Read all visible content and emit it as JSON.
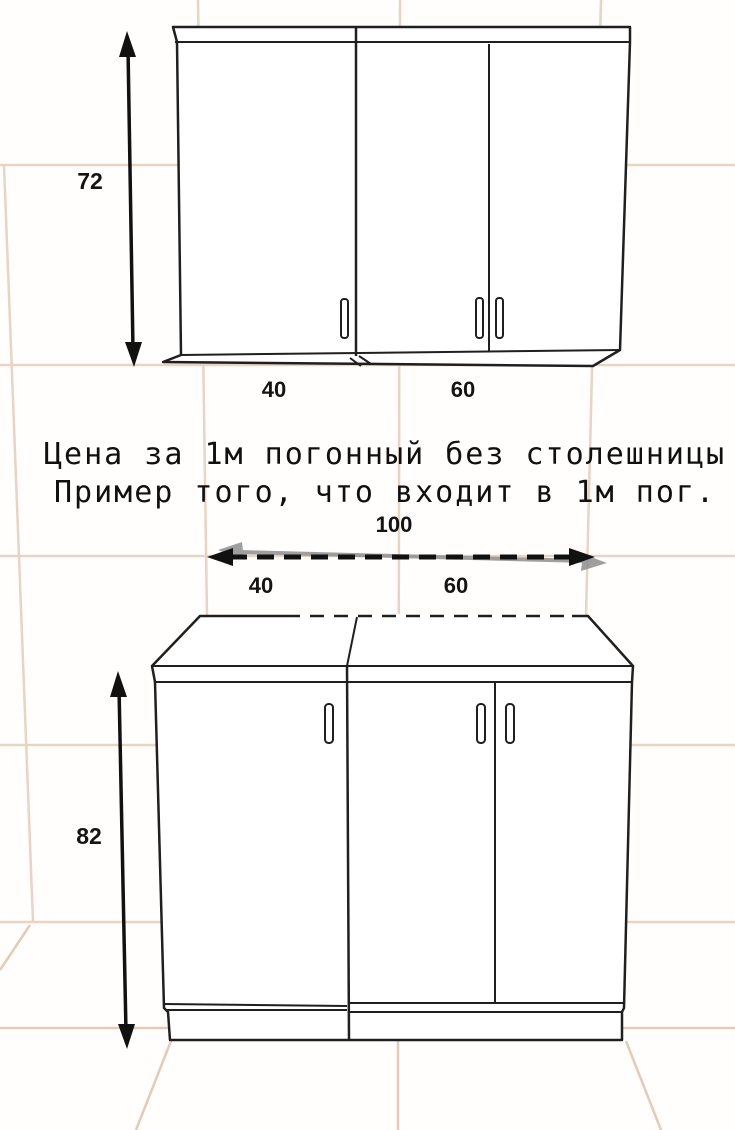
{
  "diagram": {
    "caption": {
      "line1": "Цена за 1м погонный без столешницы",
      "line2": "Пример того, что входит в 1м пог."
    },
    "wall_cabinet": {
      "height_cm": "72",
      "sections": [
        {
          "width_cm": "40",
          "doors": 1
        },
        {
          "width_cm": "60",
          "doors": 2
        }
      ]
    },
    "base_cabinet": {
      "height_cm": "82",
      "total_width_cm": "100",
      "sections": [
        {
          "width_cm": "40",
          "doors": 1
        },
        {
          "width_cm": "60",
          "doors": 2
        }
      ]
    },
    "colors": {
      "tile_line": "#e9d3c4",
      "floor_line": "#e5cab9",
      "drawing_line": "#1f1f1f",
      "ghost_gray": "#8f8f8f",
      "label_text": "#141414"
    }
  }
}
